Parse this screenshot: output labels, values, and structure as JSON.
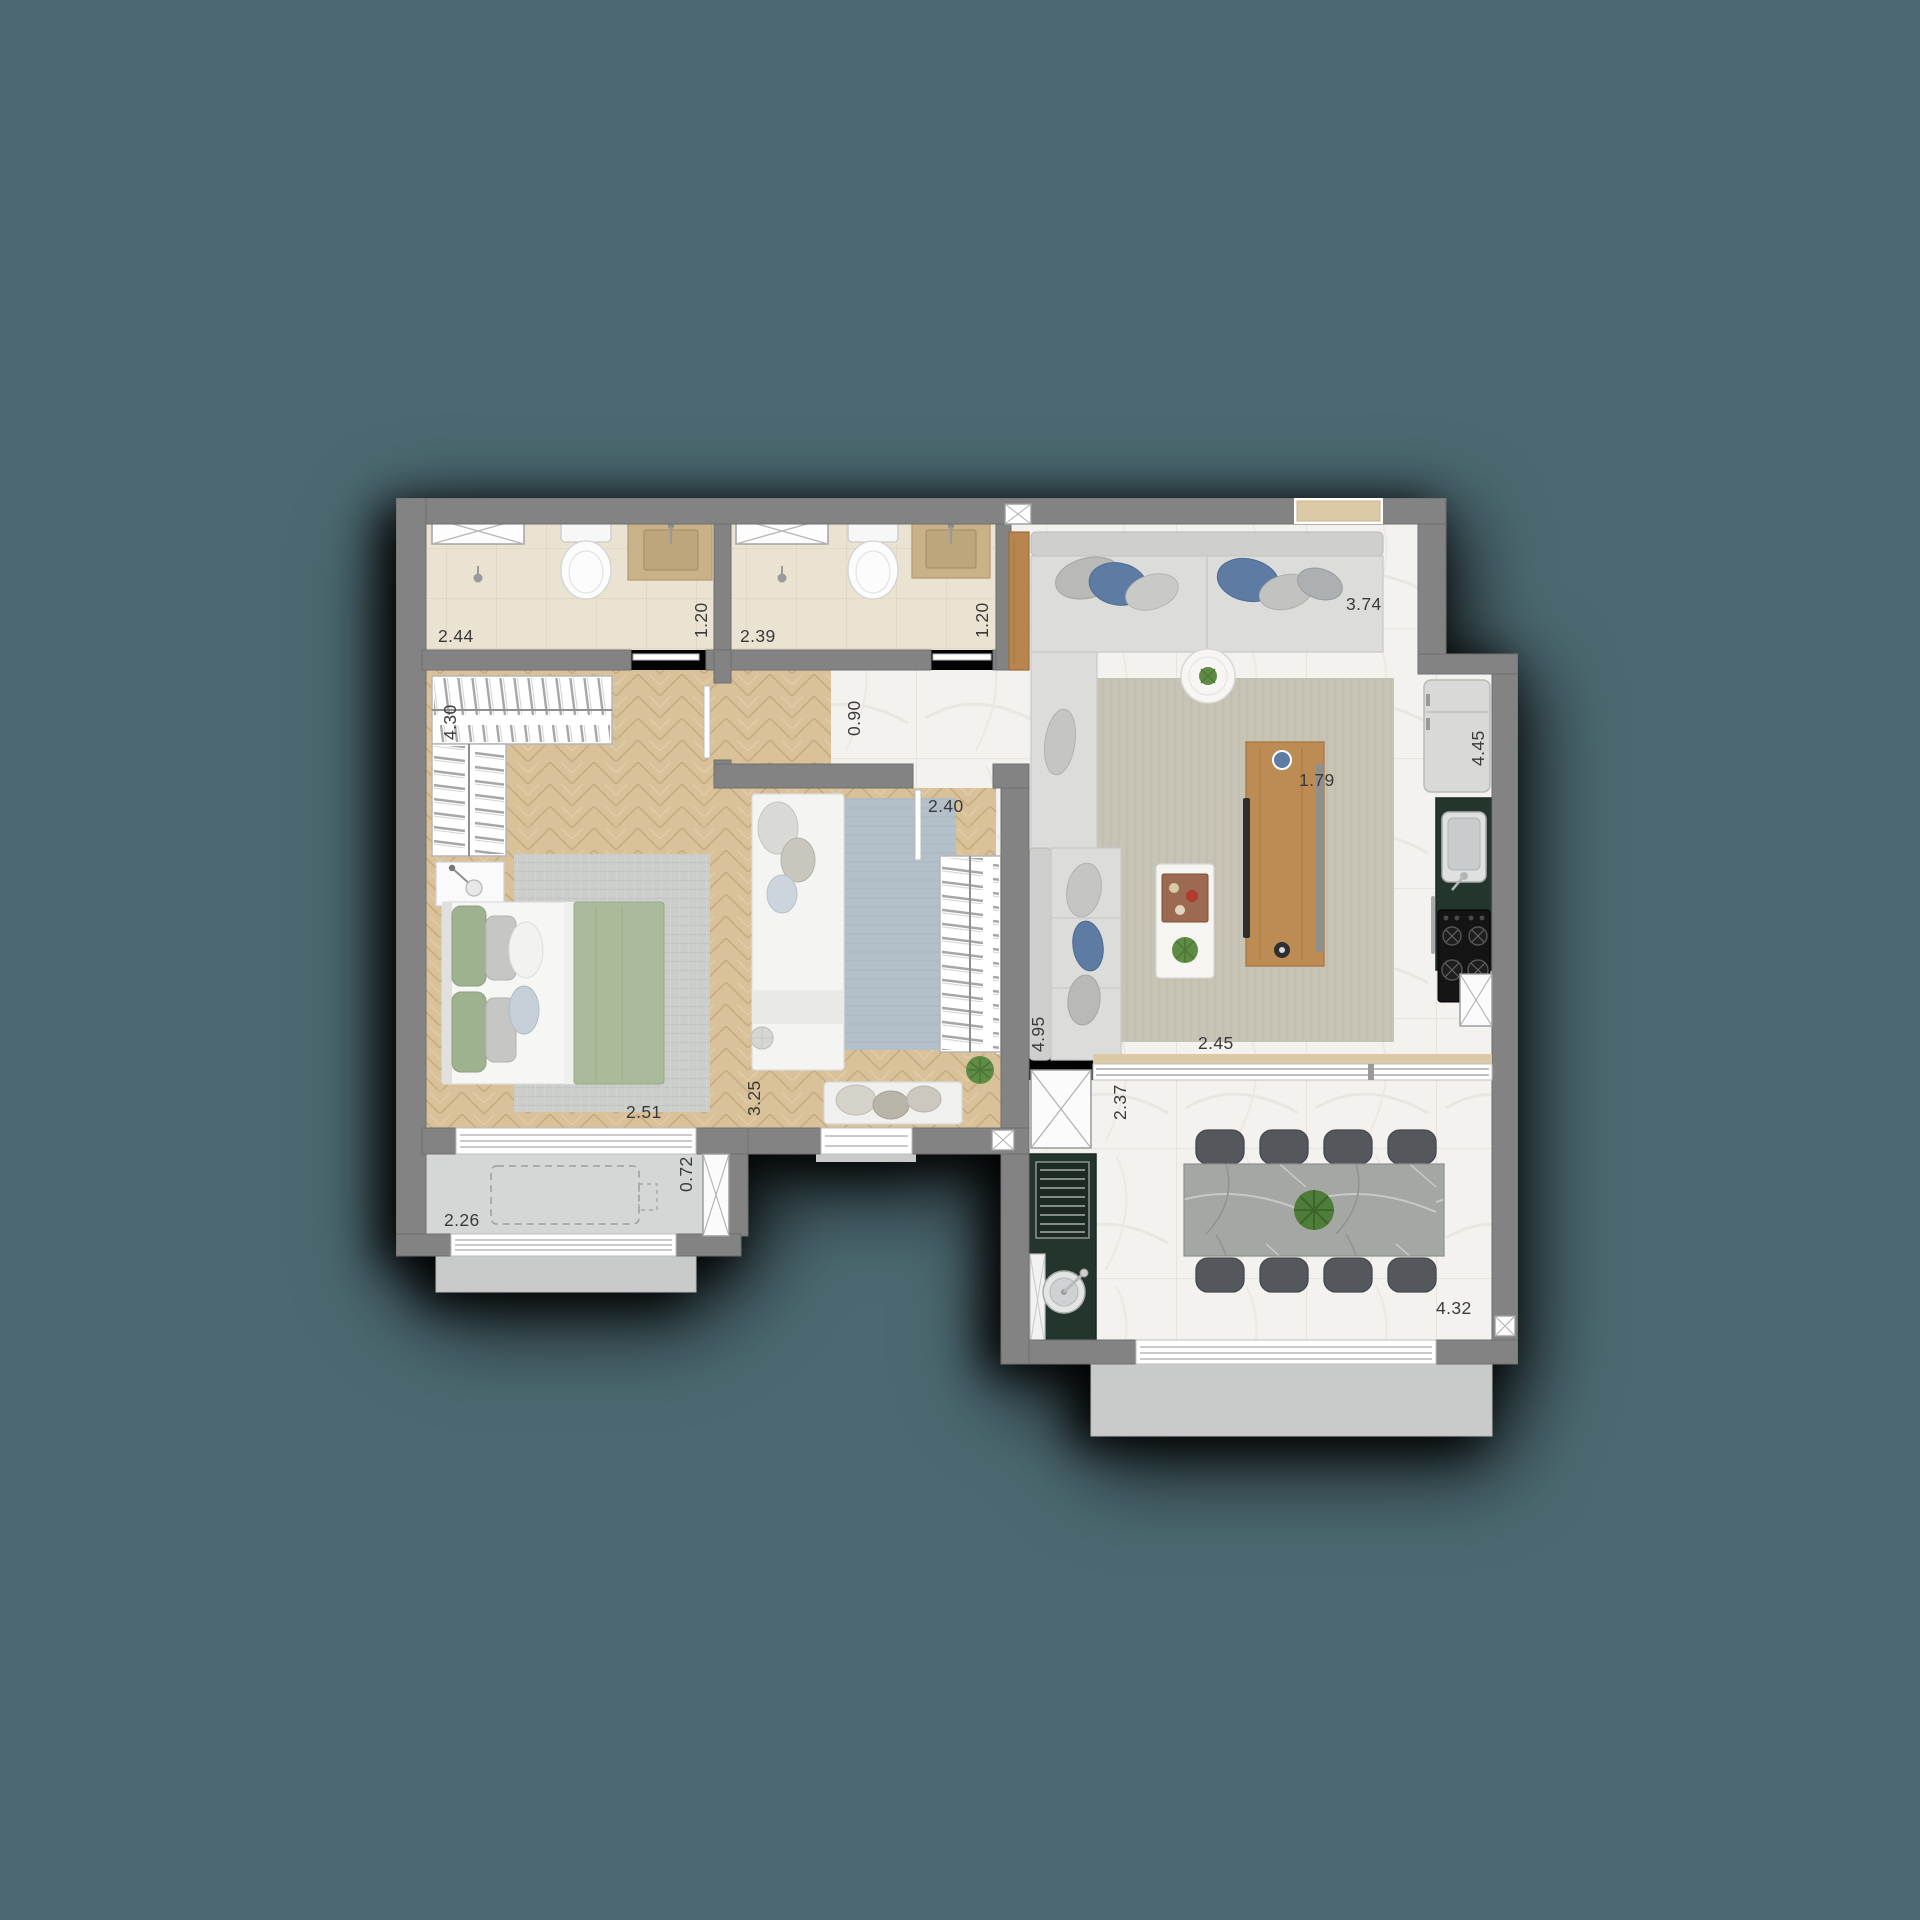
{
  "scene": {
    "type": "apartment-floor-plan-top-view"
  },
  "colors": {
    "background": "#4C6971",
    "shadow": "#000000",
    "wall": "#838383",
    "wood_floor": "#D9C19A",
    "marble_floor": "#F3F2EE",
    "bath_tile": "#EAE3D2",
    "vanity_travertine": "#C9B288",
    "counter_stone_dark": "#24352D",
    "cabinet_wood": "#BD8C55",
    "blanket_green": "#A9BB9A",
    "pillow_blue": "#5E7CA3",
    "rug_living": "#C7C4B5",
    "rug_master": "#CCCECB",
    "rug_bedroom2": "#B3BFC9",
    "balcony_floor": "#D5D7D6",
    "dining_table_stone": "#A4A7A4",
    "chair_dark": "#54575B",
    "plant_green": "#5E8C44",
    "dimension_text": "#3A3A3A"
  },
  "icons": {
    "shaft_icon": "box-with-diagonal-cross (duct/shaft)",
    "shower_icon": "glass-box-with-diagonal-cross",
    "door_icon": "open-door-leaf",
    "sink_icon": "basin-with-faucet",
    "cooktop_icon": "four-burner-stove",
    "grill_icon": "barbecue-grate",
    "plant_icon": "round-foliage"
  },
  "dimensions": {
    "suite_bath_length": "2.44",
    "suite_bath_width": "1.20",
    "bath2_length": "2.39",
    "bath2_width": "1.20",
    "living_width": "3.74",
    "kitchen_length": "4.45",
    "master_closet": "4.30",
    "hall_width": "0.90",
    "bedroom2_width": "2.40",
    "tv_panel": "1.79",
    "living_length": "4.95",
    "terrace_opening": "2.45",
    "master_window": "2.51",
    "bedroom2_length": "3.25",
    "terrace_depth": "2.37",
    "balcony_depth": "0.72",
    "balcony_width": "2.26",
    "terrace_width": "4.32"
  }
}
